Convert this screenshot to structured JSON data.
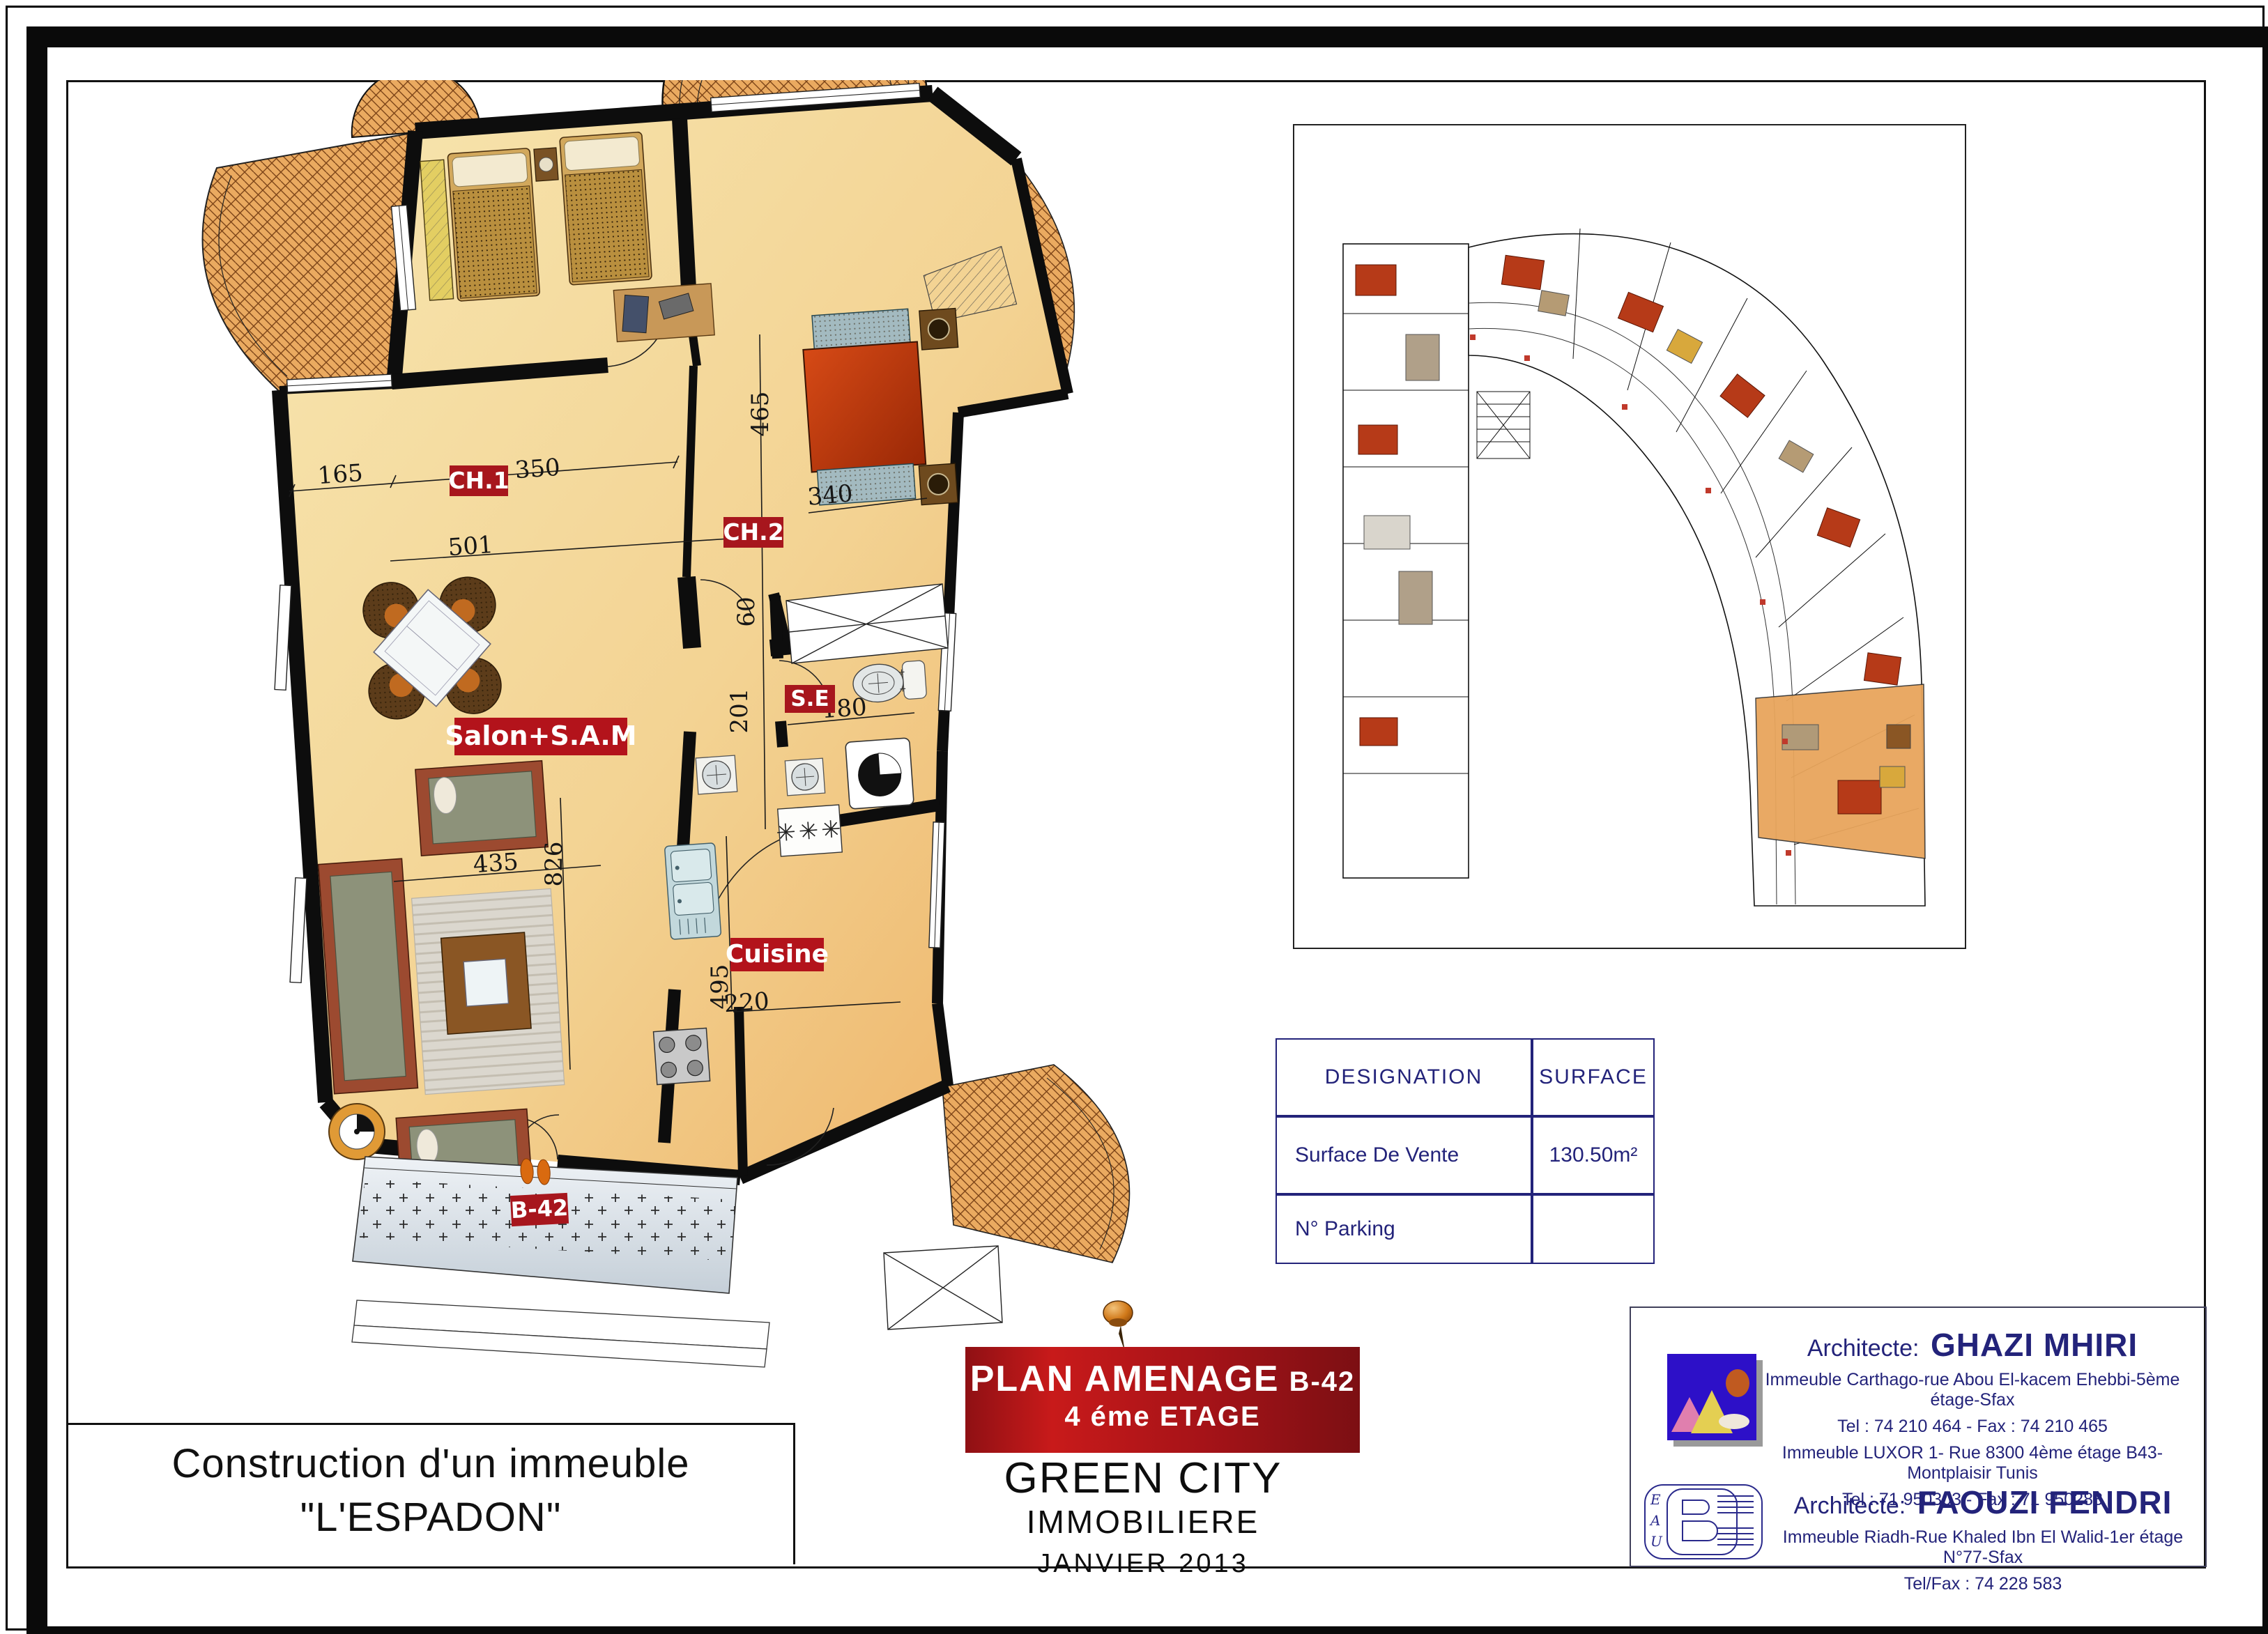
{
  "page": {
    "project_title_line1": "Construction d'un immeuble",
    "project_title_line2": "\"L'ESPADON\"",
    "banner": {
      "title": "PLAN AMENAGE",
      "unit": "B-42",
      "floor": "4 éme  ETAGE"
    },
    "company": {
      "name": "GREEN CITY",
      "subtitle": "IMMOBILIERE",
      "date": "JANVIER  2013"
    }
  },
  "surface_table": {
    "col_designation": "DESIGNATION",
    "col_surface": "SURFACE",
    "rows": [
      {
        "designation": "Surface De Vente",
        "surface": "130.50m²"
      },
      {
        "designation": "N°  Parking",
        "surface": ""
      }
    ]
  },
  "architects": {
    "label": "Architecte:",
    "first": {
      "name": "GHAZI MHIRI",
      "address1": "Immeuble Carthago-rue Abou El-kacem Ehebbi-5ème étage-Sfax",
      "tel1": "Tel : 74 210 464 - Fax : 74 210 465",
      "address2": "Immeuble LUXOR 1- Rue 8300 4ème étage B43-Montplaisir Tunis",
      "tel2": "Tel : 71 950303 - Fax : 71 950288"
    },
    "second": {
      "name": "FAOUZI FENDRI",
      "address1": "Immeuble Riadh-Rue Khaled Ibn El Walid-1er étage N°77-Sfax",
      "tel1": "Tel/Fax : 74 228 583"
    }
  },
  "floor_plan": {
    "rooms": {
      "ch1": "CH.1",
      "ch2": "CH.2",
      "salon": "Salon+S.A.M",
      "se": "S.E",
      "cuisine": "Cuisine",
      "unit": "B-42"
    },
    "dims": {
      "d165": "165",
      "d350": "350",
      "d501": "501",
      "d465": "465",
      "d340": "340",
      "d60": "60",
      "d201": "201",
      "d180": "180",
      "d435": "435",
      "d826": "826",
      "d495": "495",
      "d220": "220"
    },
    "fridge_mark": "✳✳✳"
  },
  "colors": {
    "label_red": "#a7161d",
    "banner_red": "#a61318",
    "navy": "#23237a",
    "wall": "#0d0d0d",
    "floor": "#f4dfa4",
    "tile": "#e9a95f",
    "terrace_gray": "#dfe6ec"
  }
}
